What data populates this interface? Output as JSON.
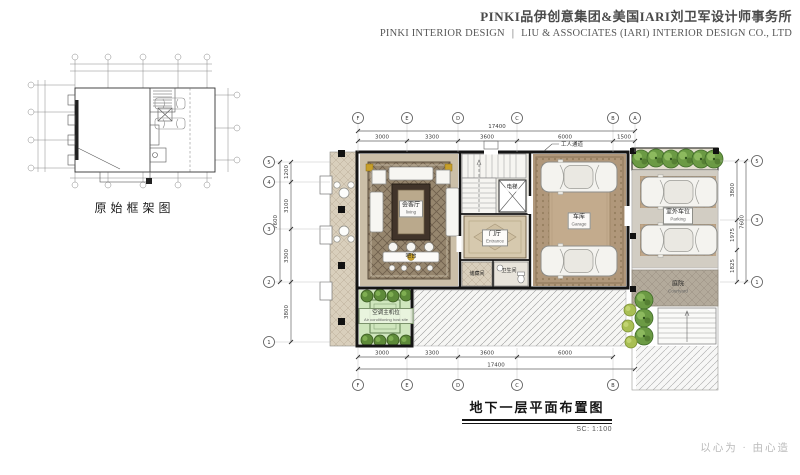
{
  "header": {
    "company_cn": "PINKI品伊创意集团&美国IARI刘卫军设计师事务所",
    "company_en": "PINKI INTERIOR DESIGN",
    "divider": "|",
    "company_en2": "LIU & ASSOCIATES (IARI) INTERIOR DESIGN CO., LTD"
  },
  "small_plan": {
    "caption": "原始框架图"
  },
  "main_plan": {
    "rooms": {
      "living": {
        "label": "会客厅",
        "sublabel": "living"
      },
      "bar": {
        "label": "吧台"
      },
      "elevator": {
        "label": "电梯"
      },
      "foyer": {
        "label": "门厅",
        "sublabel": "Entrance"
      },
      "storage": {
        "label": "储藏间"
      },
      "bath": {
        "label": "卫生间"
      },
      "garage": {
        "label": "车库",
        "sublabel": "Garage"
      },
      "parking": {
        "label": "室外车位",
        "sublabel": "Parking"
      },
      "courtyard": {
        "label": "庭院",
        "sublabel": "Courtyard"
      },
      "ac": {
        "label": "空调主机位",
        "sublabel": "Air conditioning host site"
      }
    },
    "annotations": {
      "worker_passage": "工人通道"
    },
    "dims": {
      "top": {
        "total": "17400",
        "segments": [
          "3000",
          "3300",
          "3600",
          "6000",
          "1500"
        ]
      },
      "bottom": {
        "total": "17400",
        "segments": [
          "3000",
          "3300",
          "3600",
          "6000"
        ]
      },
      "left": {
        "outer": "7600",
        "segments": [
          "1200",
          "3100",
          "3300",
          "3800"
        ]
      },
      "right": {
        "outer": "7600",
        "segments": [
          "3800",
          "1975",
          "1825"
        ]
      }
    },
    "grid": {
      "top_letters": [
        "F",
        "E",
        "D",
        "C",
        "B",
        "A"
      ],
      "bottom_letters": [
        "F",
        "E",
        "D",
        "C",
        "B"
      ],
      "left_numbers": [
        "5",
        "4",
        "3",
        "2",
        "1"
      ],
      "right_numbers": [
        "5",
        "3",
        "1"
      ]
    }
  },
  "title_block": {
    "title": "地下一层平面布置图",
    "scale": "SC: 1:100"
  },
  "footer": {
    "slogan": "以心为 · 由心造"
  },
  "colors": {
    "wall": "#141414",
    "living_carpet": "#96866e",
    "garage_floor": "#b0977a",
    "ac_area": "#cfe6bd",
    "tree": "#6b9a44",
    "slogan_gray": "#bababa"
  }
}
